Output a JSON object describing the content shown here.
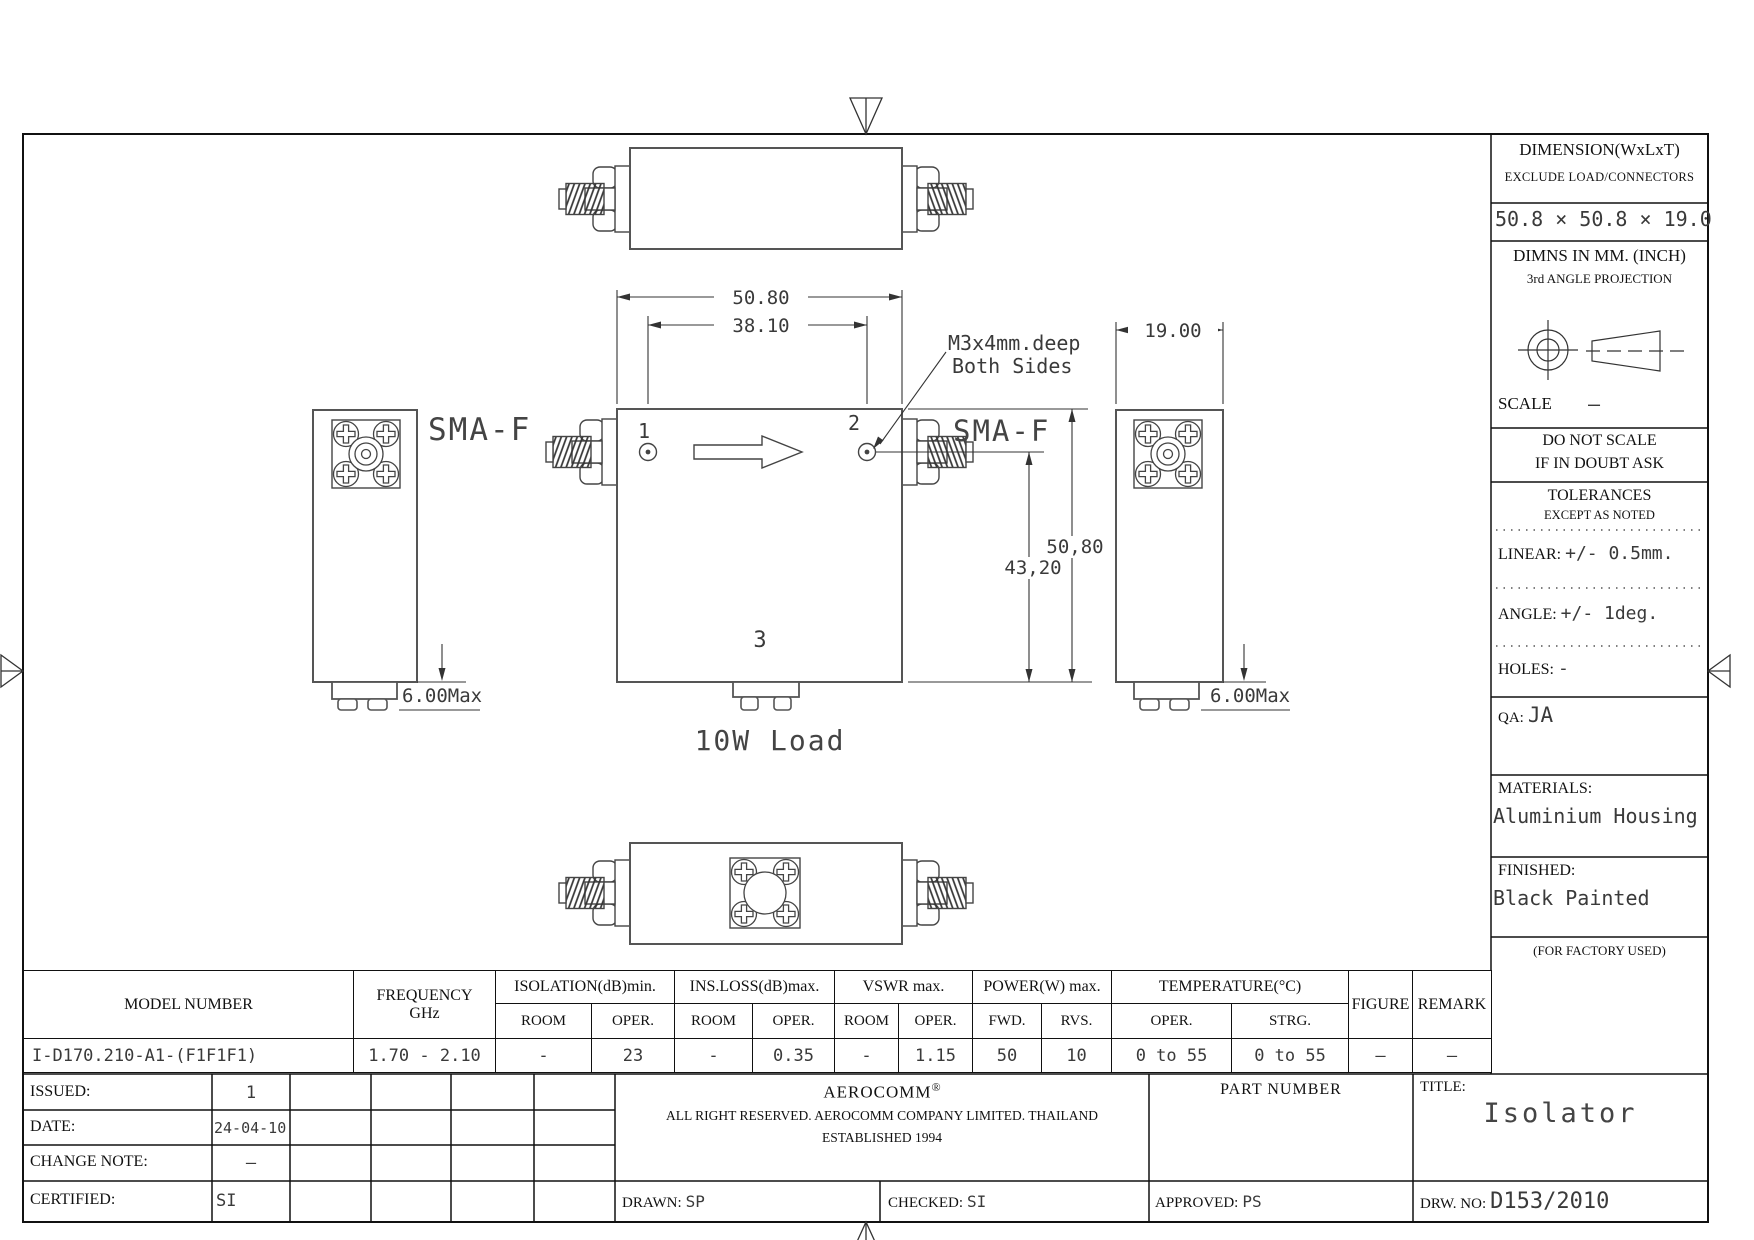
{
  "panel": {
    "dimension_title": "DIMENSION(WxLxT)",
    "dimension_sub": "EXCLUDE LOAD/CONNECTORS",
    "dimension_value": "50.8 × 50.8 × 19.0",
    "dimns_line1": "DIMNS IN MM. (INCH)",
    "dimns_line2": "3rd ANGLE PROJECTION",
    "scale_label": "SCALE",
    "scale_value": "—",
    "do_not_scale_line1": "DO NOT SCALE",
    "do_not_scale_line2": "IF IN DOUBT ASK",
    "tolerances_title": "TOLERANCES",
    "tolerances_sub": "EXCEPT AS NOTED",
    "linear_label": "LINEAR:",
    "linear_value": "+/-  0.5mm.",
    "angle_label": "ANGLE:",
    "angle_value": "+/-  1deg.",
    "holes_label": "HOLES:",
    "holes_value": "-",
    "qa_label": "QA:",
    "qa_value": "JA",
    "materials_label": "MATERIALS:",
    "materials_value": "Aluminium Housing",
    "finished_label": "FINISHED:",
    "finished_value": "Black Painted",
    "factory_note": "(FOR FACTORY USED)"
  },
  "drawing": {
    "dim_width_top": "50.80",
    "dim_hole_span": "38.10",
    "dim_depth": "19.00",
    "dim_height": "50,80",
    "dim_port_height": "43,20",
    "dim_load_left": "6.00Max",
    "dim_load_right": "6.00Max",
    "sma_left": "SMA-F",
    "sma_right": "SMA-F",
    "thread_note_line1": "M3x4mm.deep",
    "thread_note_line2": "Both Sides",
    "port1": "1",
    "port2": "2",
    "port3": "3",
    "load_label": "10W Load"
  },
  "spec_table": {
    "headers": {
      "model": "MODEL NUMBER",
      "frequency1": "FREQUENCY",
      "frequency2": "GHz",
      "isolation": "ISOLATION(dB)min.",
      "insloss": "INS.LOSS(dB)max.",
      "vswr": "VSWR  max.",
      "power": "POWER(W)  max.",
      "temperature": "TEMPERATURE(°C)",
      "figure": "FIGURE",
      "remark": "REMARK",
      "room": "ROOM",
      "oper": "OPER.",
      "fwd": "FWD.",
      "rvs": "RVS.",
      "strg": "STRG."
    },
    "row": {
      "model": "I-D170.210-A1-(F1F1F1)",
      "frequency": "1.70 - 2.10",
      "isolation_room": "-",
      "isolation_oper": "23",
      "insloss_room": "-",
      "insloss_oper": "0.35",
      "vswr_room": "-",
      "vswr_oper": "1.15",
      "power_fwd": "50",
      "power_rvs": "10",
      "temp_oper": "0 to 55",
      "temp_strg": "0 to 55",
      "figure": "—",
      "remark": "—"
    }
  },
  "title_block": {
    "issued_label": "ISSUED:",
    "issued_value": "1",
    "date_label": "DATE:",
    "date_value": "24-04-10",
    "change_note_label": "CHANGE NOTE:",
    "change_note_value": "–",
    "certified_label": "CERTIFIED:",
    "certified_value": "SI",
    "company_name": "AEROCOMM",
    "company_reg": "®",
    "company_line1": "ALL RIGHT RESERVED.  AEROCOMM COMPANY LIMITED.  THAILAND",
    "company_line2": "ESTABLISHED 1994",
    "part_number_label": "PART NUMBER",
    "title_label": "TITLE:",
    "title_value": "Isolator",
    "drawn_label": "DRAWN:",
    "drawn_value": "SP",
    "checked_label": "CHECKED:",
    "checked_value": "SI",
    "approved_label": "APPROVED:",
    "approved_value": "PS",
    "drw_no_label": "DRW. NO:",
    "drw_no_value": "D153/2010"
  }
}
